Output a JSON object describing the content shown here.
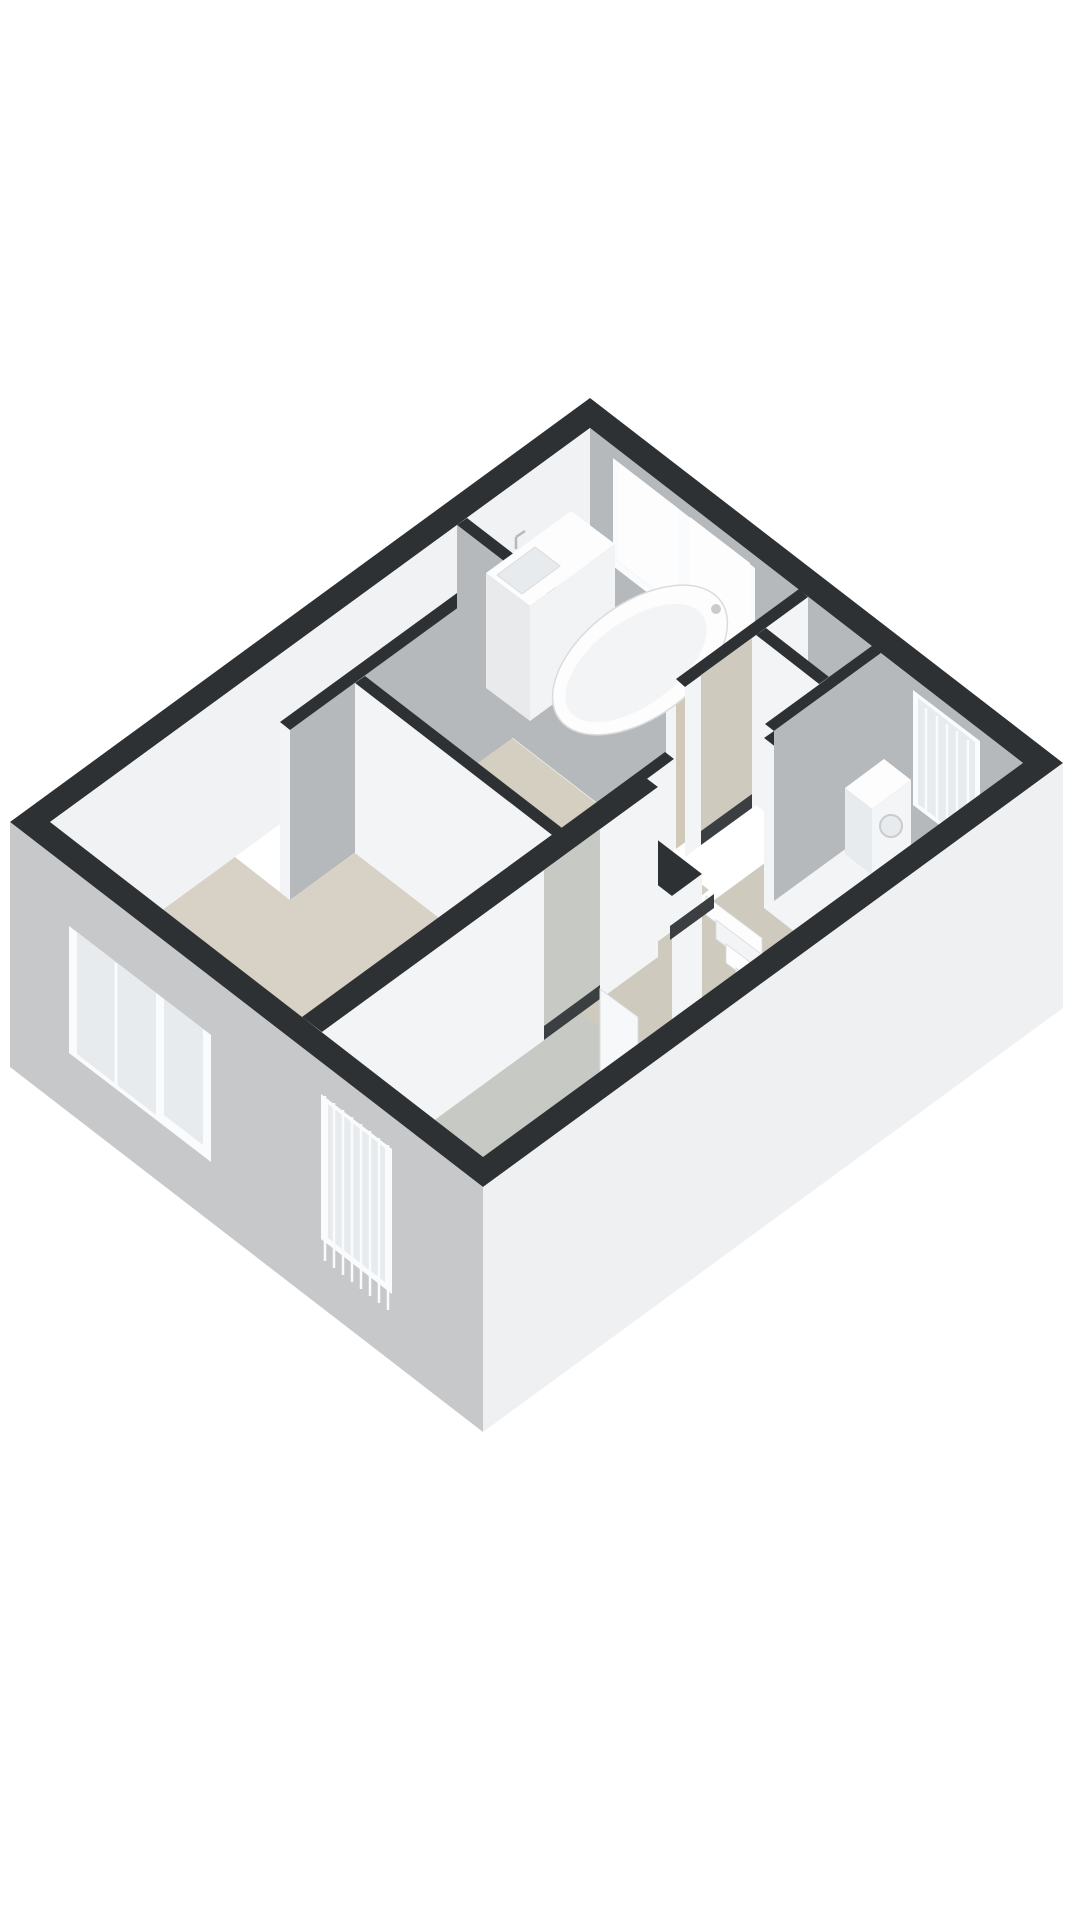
{
  "canvas": {
    "width": 1080,
    "height": 1920,
    "background": "#ffffff"
  },
  "scene": {
    "description": "3d-isometric-floorplan-upper-floor",
    "rooms": [
      "bedroom-1",
      "bedroom-2-middle",
      "bathroom",
      "landing",
      "front-bedroom",
      "toilet",
      "utility-room",
      "closet"
    ],
    "fixtures": [
      "washbasin-counter",
      "freestanding-bathtub",
      "staircase",
      "washing-machine",
      "toilet-bowl",
      "french-balcony-left",
      "french-balcony-right",
      "window-left-facade",
      "window-bathroom"
    ]
  },
  "colors": {
    "black": "#2e3133",
    "dark": "#3c3f41",
    "white": "#f3f4f6",
    "white2": "#f0f2f4",
    "white3": "#f1f3f4",
    "gray": "#b5b9bc",
    "fBed1": "#d8d2c6",
    "fMid": "#d5cfc1",
    "fBath": "#d0c9ba",
    "fLand": "#cfcabe",
    "fFront": "#c7cac4",
    "fToilet": "#d1cbbf",
    "fUtil": "#c9ccc8",
    "swFacade": "#c6c8ca",
    "seFacade": "#eff0f2",
    "frame": "#fafbfc",
    "pane": "#e7ebee",
    "paneBright": "#fdfdfe",
    "counterTop": "#fdfdfe",
    "counterSide": "#e8eaec",
    "applianceSide": "#e8ebed",
    "applianceFront": "#f3f5f6",
    "leaf": "#f7f8f9",
    "edge": "#d9dcde",
    "ring": "#c9ccce",
    "tubInner": "#f2f4f6"
  },
  "shapes": [
    {
      "n": "nw-wall-top",
      "t": "p",
      "f": "black",
      "pts": "10,822 590,398 590,428 50,822"
    },
    {
      "n": "nw-wall-inner-face",
      "t": "p",
      "f": "white2",
      "pts": "50,822 590,428 590,598 50,992"
    },
    {
      "n": "ne-wall-top",
      "t": "p",
      "f": "black",
      "pts": "590,398 1063,763 1023,763 590,428"
    },
    {
      "n": "ne-wall-inner-face",
      "t": "p",
      "f": "gray",
      "pts": "590,428 1023,763 1023,933 590,598"
    },
    {
      "n": "bathroom-window-frame",
      "t": "p",
      "f": "frame",
      "pts": "613,458 755,568 755,668 613,558"
    },
    {
      "n": "bathroom-window-pane-left",
      "t": "p",
      "f": "paneBright",
      "pts": "619,463 679,509 679,607 619,561"
    },
    {
      "n": "bathroom-window-pane-right",
      "t": "p",
      "f": "paneBright",
      "pts": "690,517 750,563 750,661 690,615"
    },
    {
      "n": "bathroom-window-sill",
      "t": "p",
      "f": "frame",
      "pts": "613,558 755,668 755,676 613,566"
    },
    {
      "n": "right-balcony-door-frame",
      "t": "p",
      "f": "frame",
      "pts": "913,690 980,741 980,856 913,805"
    },
    {
      "n": "right-balcony-door-pane",
      "t": "p",
      "f": "pane",
      "pts": "918,698 975,742 975,848 918,804"
    },
    {
      "n": "right-balustrade-bar",
      "t": "l",
      "s": "frame",
      "sw": 2.5,
      "x1": 916,
      "y1": 700,
      "x2": 916,
      "y2": 806
    },
    {
      "n": "right-balustrade-bar",
      "t": "l",
      "s": "frame",
      "sw": 2.5,
      "x1": 926,
      "y1": 708,
      "x2": 926,
      "y2": 814
    },
    {
      "n": "right-balustrade-bar",
      "t": "l",
      "s": "frame",
      "sw": 2.5,
      "x1": 937,
      "y1": 716,
      "x2": 937,
      "y2": 822
    },
    {
      "n": "right-balustrade-bar",
      "t": "l",
      "s": "frame",
      "sw": 2.5,
      "x1": 947,
      "y1": 724,
      "x2": 947,
      "y2": 830
    },
    {
      "n": "right-balustrade-bar",
      "t": "l",
      "s": "frame",
      "sw": 2.5,
      "x1": 957,
      "y1": 731,
      "x2": 957,
      "y2": 837
    },
    {
      "n": "right-balustrade-bar",
      "t": "l",
      "s": "frame",
      "sw": 2.5,
      "x1": 968,
      "y1": 740,
      "x2": 968,
      "y2": 846
    },
    {
      "n": "right-balustrade-bar",
      "t": "l",
      "s": "frame",
      "sw": 2.5,
      "x1": 978,
      "y1": 747,
      "x2": 978,
      "y2": 853
    },
    {
      "n": "bedroom1-floor",
      "t": "p",
      "f": "fBed1",
      "pts": "50,992 235,857 290,900 355,853 552,1005 302,1187"
    },
    {
      "n": "middle-room-floor",
      "t": "p",
      "f": "fMid",
      "pts": "365,846 512,738 709,890 562,998"
    },
    {
      "n": "bathroom-floor",
      "t": "p",
      "f": "fBath",
      "pts": "467,688 590,598 799,759 676,849"
    },
    {
      "n": "front-room-floor",
      "t": "p",
      "f": "fFront",
      "pts": "322,1202 648,964 809,1089 483,1327"
    },
    {
      "n": "landing-floor",
      "t": "p",
      "f": "fLand",
      "pts": "571,1005 799,838 944,949 716,1116"
    },
    {
      "n": "toilet-floor",
      "t": "p",
      "f": "fToilet",
      "pts": "756,790 799,759 872,816 829,847"
    },
    {
      "n": "utility-floor",
      "t": "p",
      "f": "fUtil",
      "pts": "774,901 881,823 1008,921 900,999"
    },
    {
      "n": "closet-wall-face",
      "t": "p",
      "f": "gray",
      "pts": "290,730 522,561 522,731 290,900"
    },
    {
      "n": "closet-wall-endcap",
      "t": "p",
      "f": "white",
      "pts": "280,722 290,730 290,900 280,892"
    },
    {
      "n": "closet-wall-top",
      "t": "p",
      "f": "black",
      "pts": "280,722 512,553 522,561 290,730"
    },
    {
      "n": "bathroom-partition-face-bath",
      "t": "p",
      "f": "white",
      "pts": "467,518 676,679 676,849 467,688"
    },
    {
      "n": "bathroom-partition-top",
      "t": "p",
      "f": "black",
      "pts": "457,525 467,518 676,679 666,686"
    },
    {
      "n": "bathroom-partition-face-mid",
      "t": "p",
      "f": "gray",
      "pts": "457,525 666,686 666,856 457,695"
    },
    {
      "n": "washbasin-counter-top",
      "t": "p",
      "f": "counterTop",
      "pts": "486,573 571,511 615,544 530,606"
    },
    {
      "n": "washbasin-counter-front",
      "t": "p",
      "f": "white3",
      "pts": "530,606 615,544 615,659 530,721"
    },
    {
      "n": "washbasin-counter-side",
      "t": "p",
      "f": "counterSide",
      "pts": "486,573 530,606 530,721 486,688"
    },
    {
      "n": "washbasin-basin",
      "t": "p",
      "f": "pane",
      "s": "edge",
      "sw": 1,
      "pts": "497,575 535,547 560,566 522,594"
    },
    {
      "n": "washbasin-faucet",
      "t": "l",
      "s": "gray",
      "sw": 2.5,
      "x1": 516,
      "y1": 549,
      "x2": 516,
      "y2": 537
    },
    {
      "n": "washbasin-faucet-spout",
      "t": "l",
      "s": "gray",
      "sw": 2.5,
      "x1": 516,
      "y1": 537,
      "x2": 525,
      "y2": 531
    },
    {
      "n": "bathtub-outer",
      "t": "e",
      "f": "counterTop",
      "s": "edge",
      "sw": 1.5,
      "cx": 640,
      "cy": 660,
      "rx": 100,
      "ry": 57,
      "rot": -36.2
    },
    {
      "n": "bathtub-inner",
      "t": "e",
      "f": "tubInner",
      "cx": 636,
      "cy": 663,
      "rx": 82,
      "ry": 42,
      "rot": -36.2
    },
    {
      "n": "bathtub-faucet",
      "t": "e",
      "f": "ring",
      "cx": 716,
      "cy": 609,
      "rx": 5,
      "ry": 5
    },
    {
      "n": "bath-landing-wall-face",
      "t": "p",
      "f": "white",
      "pts": "685,687 808,597 808,767 685,857"
    },
    {
      "n": "bath-landing-wall-top",
      "t": "p",
      "f": "black",
      "pts": "676,679 799,589 808,597 685,687"
    },
    {
      "n": "bathroom-doorway",
      "t": "p",
      "f": "fLand",
      "pts": "701,675 752,638 752,808 701,845"
    },
    {
      "n": "bathroom-door-threshold",
      "t": "p",
      "f": "dark",
      "pts": "701,831 752,794 752,808 701,845"
    },
    {
      "n": "toilet-wall-top",
      "t": "p",
      "f": "black",
      "pts": "756,635 766,628 829,677 819,684"
    },
    {
      "n": "toilet-wall-face",
      "t": "p",
      "f": "white",
      "pts": "756,635 819,684 819,854 756,805"
    },
    {
      "n": "toilet-wall2-top",
      "t": "p",
      "f": "black",
      "pts": "829,677 872,646 881,653 838,684"
    },
    {
      "n": "toilet-wall2-face",
      "t": "p",
      "f": "white",
      "pts": "838,684 881,653 881,823 838,854"
    },
    {
      "n": "toilet-bowl",
      "t": "e",
      "f": "counterTop",
      "s": "edge",
      "sw": 1,
      "cx": 812,
      "cy": 800,
      "rx": 13,
      "ry": 9,
      "rot": -36
    },
    {
      "n": "toilet-tank",
      "t": "p",
      "f": "white3",
      "pts": "818,776 836,763 836,781 818,794"
    },
    {
      "n": "utility-wall-top",
      "t": "p",
      "f": "black",
      "pts": "764,738 774,731 900,829 890,836"
    },
    {
      "n": "utility-wall-face",
      "t": "p",
      "f": "white",
      "pts": "764,738 890,836 890,1006 764,908"
    },
    {
      "n": "utility-wall2-top",
      "t": "p",
      "f": "black",
      "pts": "765,724 872,646 881,653 774,731"
    },
    {
      "n": "utility-wall2-face",
      "t": "p",
      "f": "gray",
      "pts": "774,731 881,653 881,823 774,901"
    },
    {
      "n": "washing-machine-top",
      "t": "p",
      "f": "counterTop",
      "pts": "845,788 884,759 911,780 872,809"
    },
    {
      "n": "washing-machine-front",
      "t": "p",
      "f": "applianceFront",
      "pts": "872,809 911,780 911,846 872,875"
    },
    {
      "n": "washing-machine-side",
      "t": "p",
      "f": "applianceSide",
      "pts": "845,788 872,809 872,875 845,854"
    },
    {
      "n": "washing-machine-door",
      "t": "e",
      "f": "pane",
      "s": "ring",
      "sw": 2,
      "cx": 891,
      "cy": 826,
      "rx": 11,
      "ry": 11
    },
    {
      "n": "bed1-mid-wall-face-mid",
      "t": "p",
      "f": "gray",
      "pts": "365,676 562,828 562,998 365,846"
    },
    {
      "n": "bed1-mid-wall-top",
      "t": "p",
      "f": "black",
      "pts": "355,683 365,676 562,828 552,835"
    },
    {
      "n": "bed1-mid-wall-face-bed",
      "t": "p",
      "f": "white",
      "pts": "355,683 552,835 552,1005 355,853"
    },
    {
      "n": "mid-landing-wall-top",
      "t": "p",
      "f": "black",
      "pts": "562,828 665,752 674,759 571,835"
    },
    {
      "n": "mid-landing-wall-face",
      "t": "p",
      "f": "white",
      "pts": "571,835 674,759 674,929 571,1005"
    },
    {
      "n": "stair-pillar-top",
      "t": "p",
      "f": "black",
      "pts": "625,860 655,838 702,874 672,896"
    },
    {
      "n": "stair-pillar-face",
      "t": "p",
      "f": "white",
      "pts": "672,896 702,874 702,1014 672,1036"
    },
    {
      "n": "stair-tread",
      "t": "p",
      "f": "counterTop",
      "s": "edge",
      "sw": 0.8,
      "pts": "706,896 762,938 762,957 706,915"
    },
    {
      "n": "stair-tread",
      "t": "p",
      "f": "white",
      "s": "edge",
      "sw": 0.8,
      "pts": "716,920 772,962 772,981 716,939"
    },
    {
      "n": "stair-tread",
      "t": "p",
      "f": "counterTop",
      "s": "edge",
      "sw": 0.8,
      "pts": "726,944 782,986 782,1005 726,963"
    },
    {
      "n": "stair-tread",
      "t": "p",
      "f": "white",
      "s": "edge",
      "sw": 0.8,
      "pts": "736,968 792,1010 792,1029 736,987"
    },
    {
      "n": "stair-tread",
      "t": "p",
      "f": "counterTop",
      "s": "edge",
      "sw": 0.8,
      "pts": "746,992 802,1034 802,1053 746,1011"
    },
    {
      "n": "stair-tread",
      "t": "p",
      "f": "white",
      "s": "edge",
      "sw": 0.8,
      "pts": "756,1016 812,1058 812,1077 756,1035"
    },
    {
      "n": "landing-door-threshold",
      "t": "p",
      "f": "dark",
      "pts": "670,926 714,894 714,908 670,940"
    },
    {
      "n": "front-wall-top",
      "t": "p",
      "f": "black",
      "pts": "302,1017 638,772 658,787 322,1032"
    },
    {
      "n": "front-wall-face",
      "t": "p",
      "f": "white",
      "pts": "322,1032 658,787 658,957 322,1202"
    },
    {
      "n": "front-doorway",
      "t": "p",
      "f": "fFront",
      "pts": "544,870 600,829 600,999 544,1040"
    },
    {
      "n": "front-door-threshold",
      "t": "p",
      "f": "dark",
      "pts": "544,1026 600,985 600,999 544,1040"
    },
    {
      "n": "front-door-leaf",
      "t": "p",
      "f": "leaf",
      "s": "edge",
      "sw": 1,
      "pts": "600,989 638,1017 638,1152 600,1124"
    },
    {
      "n": "se-facade-top",
      "t": "p",
      "f": "black",
      "pts": "483,1187 1063,763 1023,763 483,1157"
    },
    {
      "n": "se-facade-face",
      "t": "p",
      "f": "seFacade",
      "pts": "483,1187 1063,763 1063,1008 483,1432"
    },
    {
      "n": "sw-facade-top",
      "t": "p",
      "f": "black",
      "pts": "10,822 483,1187 483,1157 50,822"
    },
    {
      "n": "sw-facade-face",
      "t": "p",
      "f": "swFacade",
      "pts": "10,822 483,1187 483,1432 10,1067"
    },
    {
      "n": "left-window-frame",
      "t": "p",
      "f": "frame",
      "pts": "69,926 211,1035 211,1162 69,1053"
    },
    {
      "n": "left-window-pane-left",
      "t": "p",
      "f": "pane",
      "pts": "77,932 156,993 156,1115 77,1054"
    },
    {
      "n": "left-window-pane-right",
      "t": "p",
      "f": "pane",
      "pts": "164,999 203,1029 203,1145 164,1115"
    },
    {
      "n": "left-window-sash",
      "t": "l",
      "s": "frame",
      "sw": 3,
      "x1": 116,
      "y1": 963,
      "x2": 116,
      "y2": 1085
    },
    {
      "n": "left-balcony-door-frame",
      "t": "p",
      "f": "frame",
      "pts": "321,1094 392,1149 392,1294 321,1239"
    },
    {
      "n": "left-balcony-door-pane",
      "t": "p",
      "f": "pane",
      "pts": "328,1104 385,1148 385,1282 328,1238"
    },
    {
      "n": "left-balustrade-bar",
      "t": "l",
      "s": "frame",
      "sw": 2.5,
      "x1": 325,
      "y1": 1096,
      "x2": 325,
      "y2": 1261
    },
    {
      "n": "left-balustrade-bar",
      "t": "l",
      "s": "frame",
      "sw": 2.5,
      "x1": 334,
      "y1": 1103,
      "x2": 334,
      "y2": 1268
    },
    {
      "n": "left-balustrade-bar",
      "t": "l",
      "s": "frame",
      "sw": 2.5,
      "x1": 343,
      "y1": 1110,
      "x2": 343,
      "y2": 1275
    },
    {
      "n": "left-balustrade-bar",
      "t": "l",
      "s": "frame",
      "sw": 2.5,
      "x1": 352,
      "y1": 1117,
      "x2": 352,
      "y2": 1282
    },
    {
      "n": "left-balustrade-bar",
      "t": "l",
      "s": "frame",
      "sw": 2.5,
      "x1": 361,
      "y1": 1124,
      "x2": 361,
      "y2": 1289
    },
    {
      "n": "left-balustrade-bar",
      "t": "l",
      "s": "frame",
      "sw": 2.5,
      "x1": 370,
      "y1": 1131,
      "x2": 370,
      "y2": 1296
    },
    {
      "n": "left-balustrade-bar",
      "t": "l",
      "s": "frame",
      "sw": 2.5,
      "x1": 379,
      "y1": 1138,
      "x2": 379,
      "y2": 1303
    },
    {
      "n": "left-balustrade-bar",
      "t": "l",
      "s": "frame",
      "sw": 2.5,
      "x1": 388,
      "y1": 1145,
      "x2": 388,
      "y2": 1310
    }
  ]
}
